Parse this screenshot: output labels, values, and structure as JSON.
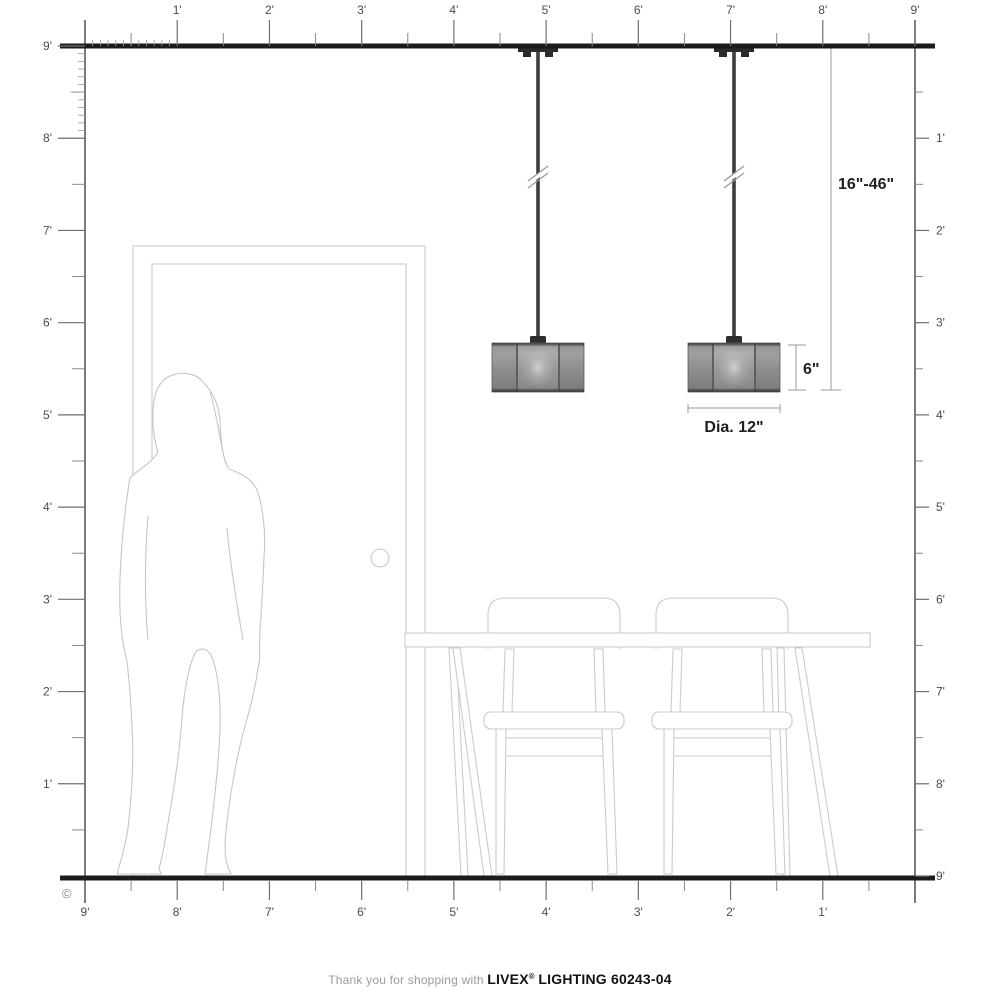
{
  "rulers": {
    "top": {
      "labels": [
        "1'",
        "2'",
        "3'",
        "4'",
        "5'",
        "6'",
        "7'",
        "8'",
        "9'"
      ]
    },
    "left": {
      "labels": [
        "9'",
        "8'",
        "7'",
        "6'",
        "5'",
        "4'",
        "3'",
        "2'",
        "1'"
      ]
    },
    "bottom": {
      "labels": [
        "9'",
        "8'",
        "7'",
        "6'",
        "5'",
        "4'",
        "3'",
        "2'",
        "1'"
      ]
    },
    "right": {
      "labels": [
        "1'",
        "2'",
        "3'",
        "4'",
        "5'",
        "6'",
        "7'",
        "8'",
        "9'"
      ]
    }
  },
  "annotations": {
    "hang_range": "16\"-46\"",
    "fixture_height": "6\"",
    "fixture_diameter": "Dia. 12\""
  },
  "copyright": "©",
  "footer": {
    "thanks": "Thank you for shopping with",
    "brand": "LIVEX",
    "registered": "®",
    "product": "LIGHTING 60243-04"
  },
  "colors": {
    "ceiling_floor_line": "#1b1b1b",
    "ruler_line": "#5a5a5a",
    "ruler_tick": "#6f6f6f",
    "furniture_outline": "#cbcbcb",
    "silhouette_outline": "#c5c5c5",
    "fixture_body": "#9a9a9a",
    "fixture_hardware": "#2e2e2e",
    "dimension_line": "#999999",
    "dimension_text": "#1f1f1f",
    "brand_text": "#121212",
    "muted_text": "#9b9b9b"
  }
}
